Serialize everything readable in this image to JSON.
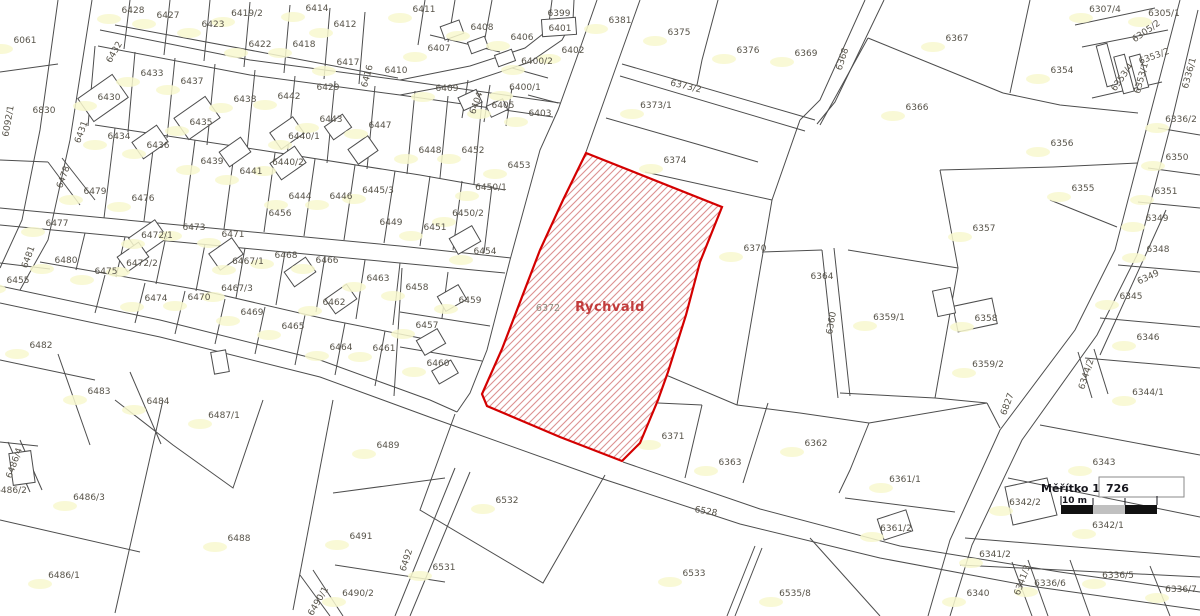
{
  "map": {
    "town_name": "Rychvald",
    "line_color": "#4d4d4d",
    "highlight": {
      "parcel_label": "6372",
      "name": "Rychvald",
      "stroke": "#d40000",
      "hatch_color": "#dc9090",
      "outline": "M586,153 L722,207 L700,262 L686,315 L668,372 L658,400 L640,443 L622,461 L560,437 L487,406 L482,394 L502,349 L540,250 L563,200 Z"
    },
    "scale": {
      "label": "Měřítko 1:",
      "value": "726",
      "bar_label": "10 m",
      "bar_colors": [
        "#111111",
        "#c0c0c0",
        "#111111"
      ]
    },
    "parcels": [
      {
        "t": "6428",
        "x": 133,
        "y": 10,
        "b": 1
      },
      {
        "t": "6427",
        "x": 168,
        "y": 15,
        "b": 1
      },
      {
        "t": "6419/2",
        "x": 247,
        "y": 13,
        "b": 1
      },
      {
        "t": "6414",
        "x": 317,
        "y": 8,
        "b": 1
      },
      {
        "t": "6423",
        "x": 213,
        "y": 24,
        "b": 1
      },
      {
        "t": "6412",
        "x": 345,
        "y": 24,
        "b": 1
      },
      {
        "t": "6061",
        "x": 25,
        "y": 40,
        "b": 1
      },
      {
        "t": "6422",
        "x": 260,
        "y": 44,
        "b": 1
      },
      {
        "t": "6418",
        "x": 304,
        "y": 44,
        "b": 1
      },
      {
        "t": "6417",
        "x": 348,
        "y": 62,
        "b": 1
      },
      {
        "t": "6416",
        "x": 367,
        "y": 76,
        "r": -75
      },
      {
        "t": "6410",
        "x": 396,
        "y": 70
      },
      {
        "t": "6433",
        "x": 152,
        "y": 73,
        "b": 1
      },
      {
        "t": "6437",
        "x": 192,
        "y": 81,
        "b": 1
      },
      {
        "t": "6429",
        "x": 328,
        "y": 87
      },
      {
        "t": "6430",
        "x": 109,
        "y": 97,
        "b": 1
      },
      {
        "t": "6438",
        "x": 245,
        "y": 99,
        "b": 1
      },
      {
        "t": "6442",
        "x": 289,
        "y": 96,
        "b": 1
      },
      {
        "t": "6830",
        "x": 44,
        "y": 110
      },
      {
        "t": "6092/1",
        "x": 8,
        "y": 121,
        "r": -80
      },
      {
        "t": "6432",
        "x": 114,
        "y": 52,
        "r": -60
      },
      {
        "t": "6431",
        "x": 81,
        "y": 132,
        "r": -70
      },
      {
        "t": "6434",
        "x": 119,
        "y": 136,
        "b": 1
      },
      {
        "t": "6436",
        "x": 158,
        "y": 145,
        "b": 1
      },
      {
        "t": "6435",
        "x": 201,
        "y": 122,
        "b": 1
      },
      {
        "t": "6440/1",
        "x": 304,
        "y": 136,
        "b": 1
      },
      {
        "t": "6443",
        "x": 331,
        "y": 119,
        "b": 1
      },
      {
        "t": "6447",
        "x": 380,
        "y": 125,
        "b": 1
      },
      {
        "t": "6439",
        "x": 212,
        "y": 161,
        "b": 1
      },
      {
        "t": "6441",
        "x": 251,
        "y": 171,
        "b": 1
      },
      {
        "t": "6440/2",
        "x": 288,
        "y": 162,
        "b": 1
      },
      {
        "t": "6444",
        "x": 300,
        "y": 196,
        "b": 1
      },
      {
        "t": "6446",
        "x": 341,
        "y": 196,
        "b": 1
      },
      {
        "t": "6445/3",
        "x": 378,
        "y": 190,
        "b": 1
      },
      {
        "t": "6478",
        "x": 63,
        "y": 177,
        "r": -70
      },
      {
        "t": "6479",
        "x": 95,
        "y": 191,
        "b": 1
      },
      {
        "t": "6476",
        "x": 143,
        "y": 198,
        "b": 1
      },
      {
        "t": "6411",
        "x": 424,
        "y": 9,
        "b": 1
      },
      {
        "t": "6399",
        "x": 559,
        "y": 13
      },
      {
        "t": "6401",
        "x": 560,
        "y": 28
      },
      {
        "t": "6381",
        "x": 620,
        "y": 20,
        "b": 1
      },
      {
        "t": "6408",
        "x": 482,
        "y": 27,
        "b": 1
      },
      {
        "t": "6406",
        "x": 522,
        "y": 37,
        "b": 1
      },
      {
        "t": "6375",
        "x": 679,
        "y": 32,
        "b": 1
      },
      {
        "t": "6407",
        "x": 439,
        "y": 48,
        "b": 1
      },
      {
        "t": "6402",
        "x": 573,
        "y": 50,
        "b": 1
      },
      {
        "t": "6376",
        "x": 748,
        "y": 50,
        "b": 1
      },
      {
        "t": "6400/2",
        "x": 537,
        "y": 61,
        "b": 1
      },
      {
        "t": "6400/1",
        "x": 525,
        "y": 87,
        "b": 1
      },
      {
        "t": "6409",
        "x": 447,
        "y": 88,
        "b": 1
      },
      {
        "t": "6404",
        "x": 476,
        "y": 103,
        "r": -70
      },
      {
        "t": "6405",
        "x": 503,
        "y": 105,
        "b": 1
      },
      {
        "t": "6403",
        "x": 540,
        "y": 113,
        "b": 1
      },
      {
        "t": "6373/2",
        "x": 686,
        "y": 86,
        "r": 13
      },
      {
        "t": "6373/1",
        "x": 656,
        "y": 105,
        "b": 1
      },
      {
        "t": "6448",
        "x": 430,
        "y": 150,
        "b": 1
      },
      {
        "t": "6452",
        "x": 473,
        "y": 150,
        "b": 1
      },
      {
        "t": "6374",
        "x": 675,
        "y": 160,
        "b": 1
      },
      {
        "t": "6453",
        "x": 519,
        "y": 165,
        "b": 1
      },
      {
        "t": "6450/1",
        "x": 491,
        "y": 187,
        "b": 1
      },
      {
        "t": "6369",
        "x": 806,
        "y": 53,
        "b": 1
      },
      {
        "t": "6368",
        "x": 842,
        "y": 59,
        "r": -72
      },
      {
        "t": "6367",
        "x": 957,
        "y": 38,
        "b": 1
      },
      {
        "t": "6307/4",
        "x": 1105,
        "y": 9,
        "b": 1
      },
      {
        "t": "6305/1",
        "x": 1164,
        "y": 13,
        "b": 1
      },
      {
        "t": "6305/2",
        "x": 1146,
        "y": 31,
        "r": -35
      },
      {
        "t": "6353/2",
        "x": 1154,
        "y": 56,
        "r": -20
      },
      {
        "t": "6353/4",
        "x": 1122,
        "y": 77,
        "r": -55
      },
      {
        "t": "6353/1",
        "x": 1141,
        "y": 78,
        "r": -75
      },
      {
        "t": "6336/1",
        "x": 1189,
        "y": 73,
        "r": -75
      },
      {
        "t": "6354",
        "x": 1062,
        "y": 70,
        "b": 1
      },
      {
        "t": "6366",
        "x": 917,
        "y": 107,
        "b": 1
      },
      {
        "t": "6356",
        "x": 1062,
        "y": 143,
        "b": 1
      },
      {
        "t": "6336/2",
        "x": 1181,
        "y": 119,
        "b": 1
      },
      {
        "t": "6350",
        "x": 1177,
        "y": 157,
        "b": 1
      },
      {
        "t": "6355",
        "x": 1083,
        "y": 188,
        "b": 1
      },
      {
        "t": "6351",
        "x": 1166,
        "y": 191,
        "b": 1
      },
      {
        "t": "6349",
        "x": 1157,
        "y": 218,
        "b": 1
      },
      {
        "t": "6348",
        "x": 1158,
        "y": 249,
        "b": 1
      },
      {
        "t": "6349",
        "x": 1148,
        "y": 277,
        "r": -25
      },
      {
        "t": "6345",
        "x": 1131,
        "y": 296,
        "b": 1
      },
      {
        "t": "6346",
        "x": 1148,
        "y": 337,
        "b": 1
      },
      {
        "t": "6477",
        "x": 57,
        "y": 223,
        "b": 1
      },
      {
        "t": "6456",
        "x": 280,
        "y": 213
      },
      {
        "t": "6473",
        "x": 194,
        "y": 227,
        "b": 1
      },
      {
        "t": "6471",
        "x": 233,
        "y": 234,
        "b": 1
      },
      {
        "t": "6472/1",
        "x": 157,
        "y": 235,
        "b": 1
      },
      {
        "t": "6481",
        "x": 28,
        "y": 257,
        "r": -70
      },
      {
        "t": "6480",
        "x": 66,
        "y": 260,
        "b": 1
      },
      {
        "t": "6455",
        "x": 18,
        "y": 280,
        "b": 1
      },
      {
        "t": "6468",
        "x": 286,
        "y": 255,
        "b": 1
      },
      {
        "t": "6466",
        "x": 327,
        "y": 260,
        "b": 1
      },
      {
        "t": "6467/1",
        "x": 248,
        "y": 261,
        "b": 1
      },
      {
        "t": "6475",
        "x": 106,
        "y": 271,
        "b": 1
      },
      {
        "t": "6472/2",
        "x": 142,
        "y": 263,
        "b": 1
      },
      {
        "t": "6463",
        "x": 378,
        "y": 278,
        "b": 1
      },
      {
        "t": "6467/3",
        "x": 237,
        "y": 288,
        "b": 1
      },
      {
        "t": "6474",
        "x": 156,
        "y": 298,
        "b": 1
      },
      {
        "t": "6470",
        "x": 199,
        "y": 297,
        "b": 1
      },
      {
        "t": "6462",
        "x": 334,
        "y": 302,
        "b": 1
      },
      {
        "t": "6469",
        "x": 252,
        "y": 312,
        "b": 1
      },
      {
        "t": "6465",
        "x": 293,
        "y": 326,
        "b": 1
      },
      {
        "t": "6464",
        "x": 341,
        "y": 347,
        "b": 1
      },
      {
        "t": "6461",
        "x": 384,
        "y": 348,
        "b": 1
      },
      {
        "t": "6482",
        "x": 41,
        "y": 345,
        "b": 1
      },
      {
        "t": "6483",
        "x": 99,
        "y": 391,
        "b": 1
      },
      {
        "t": "6484",
        "x": 158,
        "y": 401,
        "b": 1
      },
      {
        "t": "6449",
        "x": 391,
        "y": 222
      },
      {
        "t": "6450/2",
        "x": 468,
        "y": 213,
        "b": 1
      },
      {
        "t": "6451",
        "x": 435,
        "y": 227,
        "b": 1
      },
      {
        "t": "6454",
        "x": 485,
        "y": 251,
        "b": 1
      },
      {
        "t": "6458",
        "x": 417,
        "y": 287,
        "b": 1
      },
      {
        "t": "6459",
        "x": 470,
        "y": 300,
        "b": 1
      },
      {
        "t": "6457",
        "x": 427,
        "y": 325,
        "b": 1
      },
      {
        "t": "6460",
        "x": 438,
        "y": 363,
        "b": 1
      },
      {
        "t": "6372",
        "x": 548,
        "y": 308,
        "c": "dim"
      },
      {
        "t": "Rychvald",
        "x": 610,
        "y": 308,
        "c": "red"
      },
      {
        "t": "6370",
        "x": 755,
        "y": 248,
        "b": 1
      },
      {
        "t": "6364",
        "x": 822,
        "y": 276
      },
      {
        "t": "6360",
        "x": 831,
        "y": 323,
        "r": -80
      },
      {
        "t": "6359/1",
        "x": 889,
        "y": 317,
        "b": 1
      },
      {
        "t": "6357",
        "x": 984,
        "y": 228,
        "b": 1
      },
      {
        "t": "6358",
        "x": 986,
        "y": 318,
        "b": 1
      },
      {
        "t": "6359/2",
        "x": 988,
        "y": 364,
        "b": 1
      },
      {
        "t": "6344/2",
        "x": 1086,
        "y": 374,
        "r": -72
      },
      {
        "t": "6344/1",
        "x": 1148,
        "y": 392,
        "b": 1
      },
      {
        "t": "6343",
        "x": 1104,
        "y": 462,
        "b": 1
      },
      {
        "t": "6487/1",
        "x": 224,
        "y": 415,
        "b": 1
      },
      {
        "t": "6489",
        "x": 388,
        "y": 445,
        "b": 1
      },
      {
        "t": "6371",
        "x": 673,
        "y": 436,
        "b": 1
      },
      {
        "t": "6363",
        "x": 730,
        "y": 462,
        "b": 1
      },
      {
        "t": "6362",
        "x": 816,
        "y": 443,
        "b": 1
      },
      {
        "t": "6361/1",
        "x": 905,
        "y": 479,
        "b": 1
      },
      {
        "t": "6361/2",
        "x": 896,
        "y": 528,
        "b": 1
      },
      {
        "t": "6486/4",
        "x": 14,
        "y": 463,
        "r": -70
      },
      {
        "t": "6486/2",
        "x": 11,
        "y": 490
      },
      {
        "t": "6486/3",
        "x": 89,
        "y": 497,
        "b": 1
      },
      {
        "t": "6532",
        "x": 507,
        "y": 500,
        "b": 1
      },
      {
        "t": "6528",
        "x": 706,
        "y": 511,
        "r": 10
      },
      {
        "t": "6486/1",
        "x": 64,
        "y": 575,
        "b": 1
      },
      {
        "t": "6488",
        "x": 239,
        "y": 538,
        "b": 1
      },
      {
        "t": "6491",
        "x": 361,
        "y": 536,
        "b": 1
      },
      {
        "t": "6492",
        "x": 406,
        "y": 560,
        "r": -72
      },
      {
        "t": "6490/1",
        "x": 318,
        "y": 601,
        "r": -60
      },
      {
        "t": "6490/2",
        "x": 358,
        "y": 593,
        "b": 1
      },
      {
        "t": "6531",
        "x": 444,
        "y": 567,
        "b": 1
      },
      {
        "t": "6533",
        "x": 694,
        "y": 573,
        "b": 1
      },
      {
        "t": "6535/8",
        "x": 795,
        "y": 593,
        "b": 1
      },
      {
        "t": "6827",
        "x": 1007,
        "y": 404,
        "r": -70
      },
      {
        "t": "6342/2",
        "x": 1025,
        "y": 502,
        "b": 1
      },
      {
        "t": "6342/1",
        "x": 1108,
        "y": 525,
        "b": 1
      },
      {
        "t": "6341/2",
        "x": 995,
        "y": 554,
        "b": 1
      },
      {
        "t": "6341/3",
        "x": 1022,
        "y": 580,
        "r": -70
      },
      {
        "t": "6340",
        "x": 978,
        "y": 593,
        "b": 1
      },
      {
        "t": "6336/6",
        "x": 1050,
        "y": 583,
        "b": 1
      },
      {
        "t": "6336/5",
        "x": 1118,
        "y": 575,
        "b": 1
      },
      {
        "t": "6336/7",
        "x": 1181,
        "y": 589,
        "b": 1
      }
    ],
    "buildings": [
      [
        103,
        98,
        42,
        28,
        -35
      ],
      [
        150,
        142,
        30,
        20,
        -35
      ],
      [
        197,
        118,
        38,
        26,
        -35
      ],
      [
        235,
        152,
        26,
        18,
        -35
      ],
      [
        287,
        133,
        28,
        20,
        -35
      ],
      [
        288,
        163,
        30,
        20,
        -35
      ],
      [
        338,
        127,
        22,
        16,
        -35
      ],
      [
        363,
        150,
        24,
        18,
        -35
      ],
      [
        452,
        30,
        20,
        14,
        -20
      ],
      [
        478,
        45,
        18,
        12,
        -20
      ],
      [
        505,
        58,
        18,
        12,
        -20
      ],
      [
        470,
        100,
        20,
        14,
        -25
      ],
      [
        497,
        108,
        18,
        12,
        -25
      ],
      [
        148,
        238,
        32,
        22,
        -35
      ],
      [
        133,
        257,
        26,
        18,
        -35
      ],
      [
        226,
        254,
        28,
        20,
        -35
      ],
      [
        300,
        272,
        26,
        18,
        -35
      ],
      [
        341,
        299,
        26,
        18,
        -35
      ],
      [
        465,
        240,
        26,
        18,
        -30
      ],
      [
        452,
        298,
        24,
        17,
        -30
      ],
      [
        431,
        342,
        24,
        17,
        -30
      ],
      [
        445,
        372,
        22,
        15,
        -30
      ],
      [
        975,
        315,
        40,
        26,
        -12
      ],
      [
        944,
        302,
        18,
        26,
        -12
      ],
      [
        895,
        525,
        30,
        22,
        -18
      ],
      [
        1107,
        65,
        11,
        42,
        -15
      ],
      [
        1124,
        74,
        11,
        38,
        -15
      ],
      [
        1139,
        72,
        11,
        34,
        -15
      ],
      [
        220,
        362,
        15,
        22,
        -10
      ],
      [
        22,
        468,
        22,
        32,
        -8
      ],
      [
        559,
        27,
        34,
        17,
        -4
      ]
    ]
  }
}
